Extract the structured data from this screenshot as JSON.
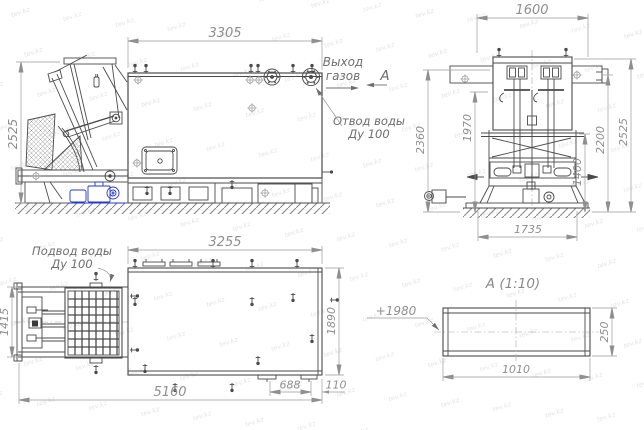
{
  "watermark": {
    "text": "tev.kz"
  },
  "colors": {
    "machine_line": "#4a4a4a",
    "dim_line": "#9a9a9a",
    "dim_text": "#8f8f8f",
    "callout_text": "#6e6e6e",
    "motor_accent": "#2438c8",
    "ground_line": "#5a5a5a",
    "watermark_gray": "#e2e2e2"
  },
  "views": {
    "side": {
      "dim_width": "3305",
      "dim_height": "2525"
    },
    "front": {
      "dim_width": "1600",
      "dim_h_2360": "2360",
      "dim_h_1970": "1970",
      "dim_h_1400": "1400",
      "dim_h_2200": "2200",
      "dim_h_2525": "2525",
      "dim_base": "1735"
    },
    "plan": {
      "dim_width": "3255",
      "dim_left": "1415",
      "dim_right": "1890",
      "dim_total": "5160",
      "dim_688": "688",
      "dim_110": "110"
    },
    "section": {
      "title": "А  (1:10)",
      "elevation": "+1980",
      "dim_width": "1010",
      "dim_height": "250"
    }
  },
  "callouts": {
    "gas_outlet_line1": "Выход",
    "gas_outlet_line2": "газов",
    "section_marker": "А",
    "water_outlet_line1": "Отвод воды",
    "water_outlet_line2": "Ду 100",
    "water_inlet_line1": "Подвод воды",
    "water_inlet_line2": "Ду 100"
  }
}
